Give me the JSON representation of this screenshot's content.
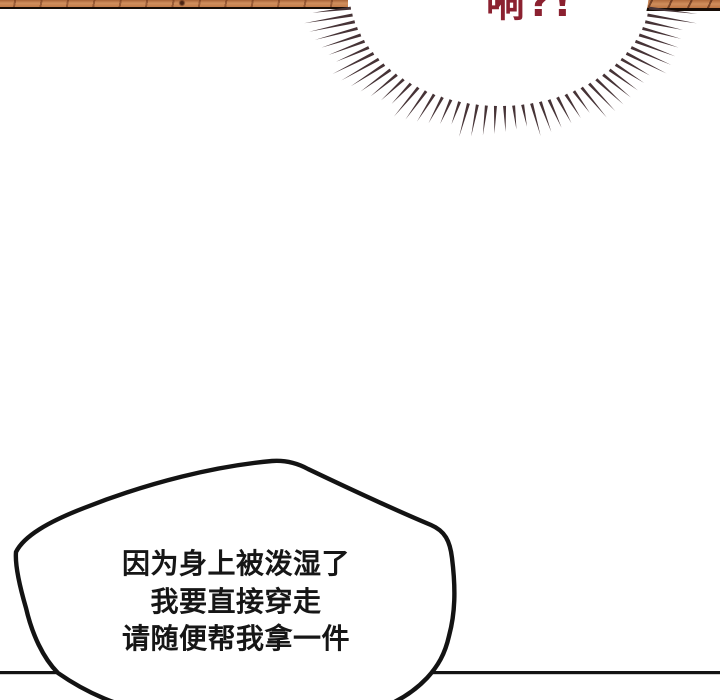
{
  "panel": {
    "type": "comic-panel",
    "shout": {
      "text": "嗬?!",
      "color": "#8b2130"
    },
    "speech_bubble": {
      "lines": [
        "因为身上被泼湿了",
        "我要直接穿走",
        "请随便帮我拿一件"
      ],
      "text_color": "#161616",
      "fill": "#ffffff",
      "outline_color": "#131313"
    },
    "colors": {
      "background": "#ffffff",
      "ink": "#131313",
      "wood_base": "#c98551",
      "wood_grain": "#5e2610",
      "burst_spike": "#463336"
    }
  }
}
